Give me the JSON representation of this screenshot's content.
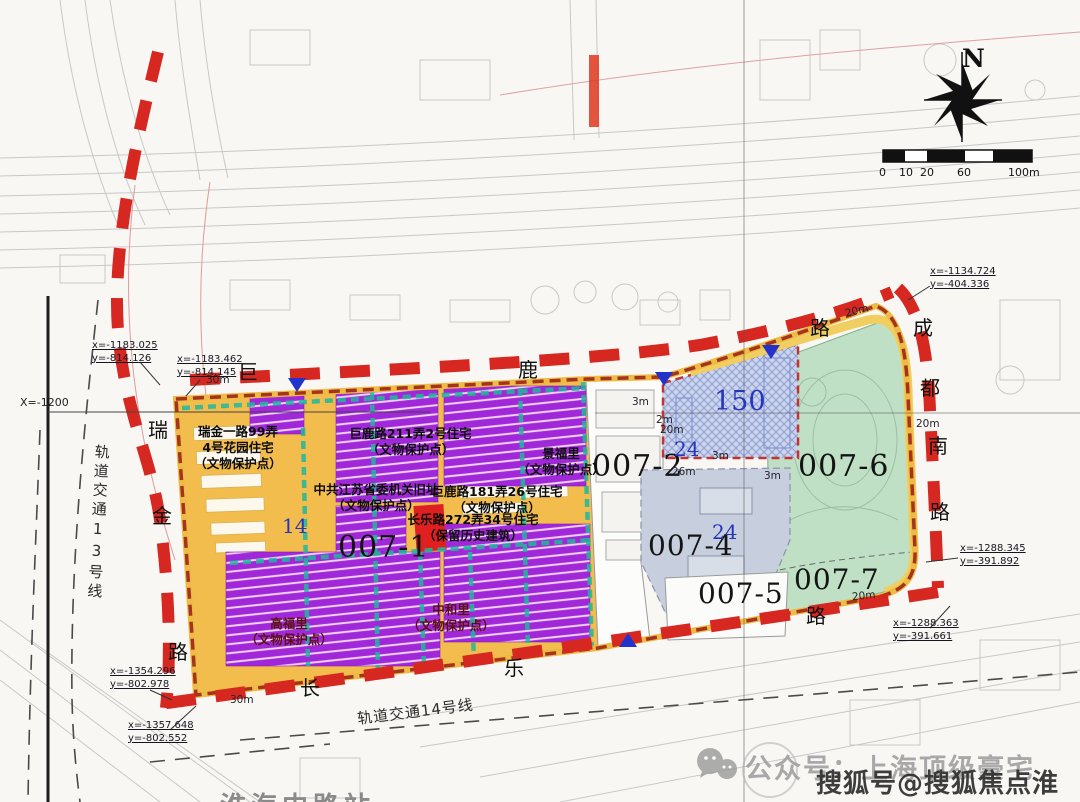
{
  "compass": {
    "label": "N"
  },
  "scale_bar": {
    "ticks": [
      "0",
      "10",
      "20",
      "60",
      "100m"
    ]
  },
  "parcels": {
    "p1": "007-1",
    "p2": "007-2",
    "p4": "007-4",
    "p5": "007-5",
    "p6": "007-6",
    "p7": "007-7"
  },
  "blue_marks": {
    "m14": "14",
    "m150": "150",
    "m24a": "24",
    "m24b": "24"
  },
  "roads": {
    "julu": [
      "巨",
      "鹿",
      "路"
    ],
    "chengdu": [
      "成",
      "都",
      "南",
      "路"
    ],
    "ruijin": [
      "瑞",
      "金",
      "路"
    ],
    "changle": [
      "长",
      "乐",
      "路"
    ]
  },
  "transit": {
    "line13": "轨道交通13号线",
    "line14": "轨道交通14号线",
    "station": "淮海中路站"
  },
  "heritage": [
    {
      "lines": [
        "瑞金一路99弄",
        "4号花园住宅",
        "（文物保护点）"
      ]
    },
    {
      "lines": [
        "巨鹿路211弄2号住宅",
        "（文物保护点）"
      ]
    },
    {
      "lines": [
        "景福里",
        "（文物保护点）"
      ]
    },
    {
      "lines": [
        "中共江苏省委机关旧址",
        "（文物保护点）"
      ]
    },
    {
      "lines": [
        "巨鹿路181弄26号住宅",
        "（文物保护点）"
      ]
    },
    {
      "lines": [
        "长乐路272弄34号住宅",
        "（保留历史建筑）"
      ]
    },
    {
      "lines": [
        "中和里",
        "（文物保护点）"
      ]
    },
    {
      "lines": [
        "高福里",
        "（文物保护点）"
      ]
    }
  ],
  "coordinates": [
    {
      "x": "x=-1183.025",
      "y": "y=-814.126"
    },
    {
      "x": "x=-1183.462",
      "y": "y=-814.145"
    },
    {
      "x": "x=-1134.724",
      "y": "y=-404.336"
    },
    {
      "x": "x=-1288.345",
      "y": "y=-391.892"
    },
    {
      "x": "x=-1288.363",
      "y": "y=-391.661"
    },
    {
      "x": "x=-1354.296",
      "y": "y=-802.978"
    },
    {
      "x": "x=-1357.648",
      "y": "y=-802.552"
    }
  ],
  "grid": {
    "x_label": "X=-1200"
  },
  "dims": {
    "d30a": "30m",
    "d30b": "30m",
    "d20a": "20m",
    "d20b": "20m",
    "d20c": "20m",
    "d20d": "20m",
    "d26": "26m",
    "d3a": "3m",
    "d3b": "3m",
    "d3c": "3m",
    "d2a": "2m"
  },
  "watermark": {
    "wechat": "公众号：上海顶级豪宅",
    "sohu": "搜狐号@搜狐焦点淮南站"
  },
  "colors": {
    "boundary_red": "#d62821",
    "site_yellow": "#f3bd4e",
    "heritage_purple": "#a128d8",
    "greenland": "#bfe0c4",
    "hatch_blue": "#cdd5ec",
    "lane_teal": "#1fb89c"
  }
}
